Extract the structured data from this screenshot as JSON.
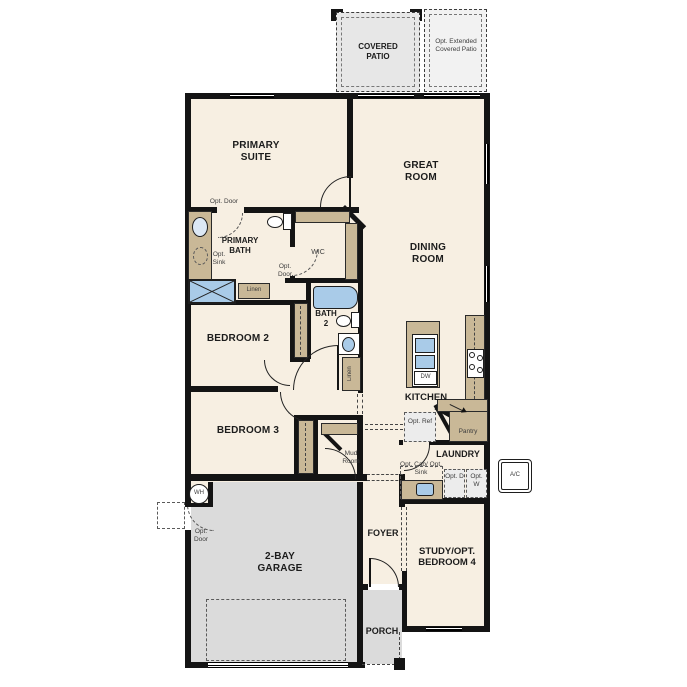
{
  "colors": {
    "floor": "#f7efe2",
    "wall": "#141414",
    "counter": "#c9b897",
    "fixture": "#a9cbe8",
    "garage": "#dbdbdb",
    "patio": "#e7e7e7",
    "patio_ext": "#f2f2f2",
    "label": "#1c1c1c",
    "label_muted": "#3d3d3d"
  },
  "patio": {
    "covered": "COVERED PATIO",
    "extended": "Opt. Extended Covered Patio"
  },
  "rooms": {
    "primary_suite": "PRIMARY SUITE",
    "great_room": "GREAT ROOM",
    "dining_room": "DINING ROOM",
    "primary_bath": "PRIMARY BATH",
    "wic": "WIC",
    "bath2": "BATH 2",
    "bedroom2": "BEDROOM 2",
    "bedroom3": "BEDROOM 3",
    "kitchen": "KITCHEN",
    "laundry": "LAUNDRY",
    "mud_room": "Mud Room",
    "garage": "2-BAY GARAGE",
    "foyer": "FOYER",
    "porch": "PORCH",
    "study": "STUDY/OPT. BEDROOM 4"
  },
  "features": {
    "opt_door_bath": "Opt. Door",
    "opt_door_wic": "Opt. Door",
    "opt_door_garage": "Opt. Door",
    "opt_sink": "Opt. Sink",
    "linen_bath1": "Linen",
    "linen_hall": "Linen",
    "pantry": "Pantry",
    "opt_ref": "Opt. Ref",
    "opt_cab_sink": "Opt. Cab/ Opt. Sink",
    "opt_dryer": "Opt. D",
    "opt_washer": "Opt. W",
    "dishwasher": "DW",
    "water_heater": "WH",
    "ac_unit": "A/C"
  }
}
